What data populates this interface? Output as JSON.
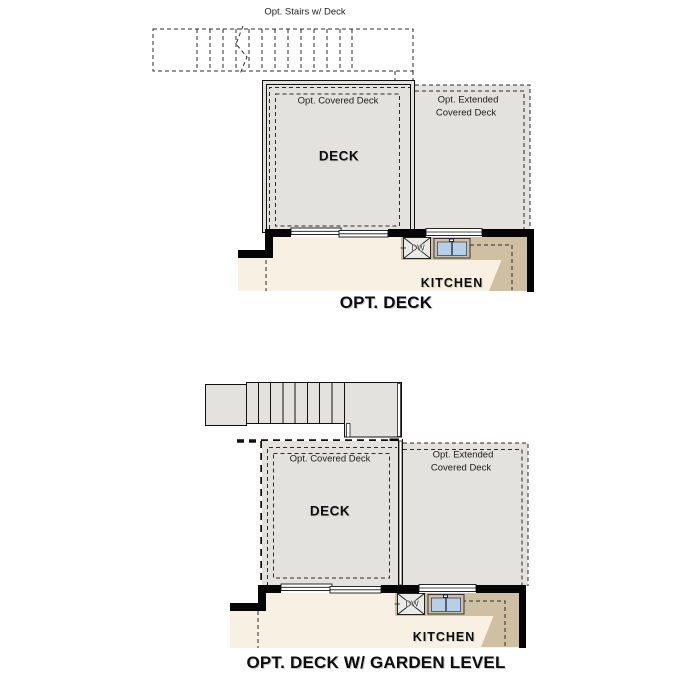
{
  "plans": {
    "top": {
      "stairs_note": "Opt. Stairs w/ Deck",
      "covered_deck_label": "Opt. Covered Deck",
      "extended_deck_label_line1": "Opt. Extended",
      "extended_deck_label_line2": "Covered Deck",
      "deck_label": "DECK",
      "dishwasher_label": "DW",
      "kitchen_label": "KITCHEN",
      "title": "OPT. DECK"
    },
    "bottom": {
      "covered_deck_label": "Opt. Covered Deck",
      "extended_deck_label_line1": "Opt. Extended",
      "extended_deck_label_line2": "Covered Deck",
      "deck_label": "DECK",
      "dishwasher_label": "DW",
      "kitchen_label": "KITCHEN",
      "title": "OPT. DECK W/ GARDEN LEVEL"
    }
  },
  "colors": {
    "deck_fill": "#e3e2de",
    "floor_fill": "#f8f0e2",
    "counter_fill": "#cfc0a3",
    "sink_fill": "#b7cfe9",
    "wall": "#050505",
    "line": "#2b2b2b"
  }
}
